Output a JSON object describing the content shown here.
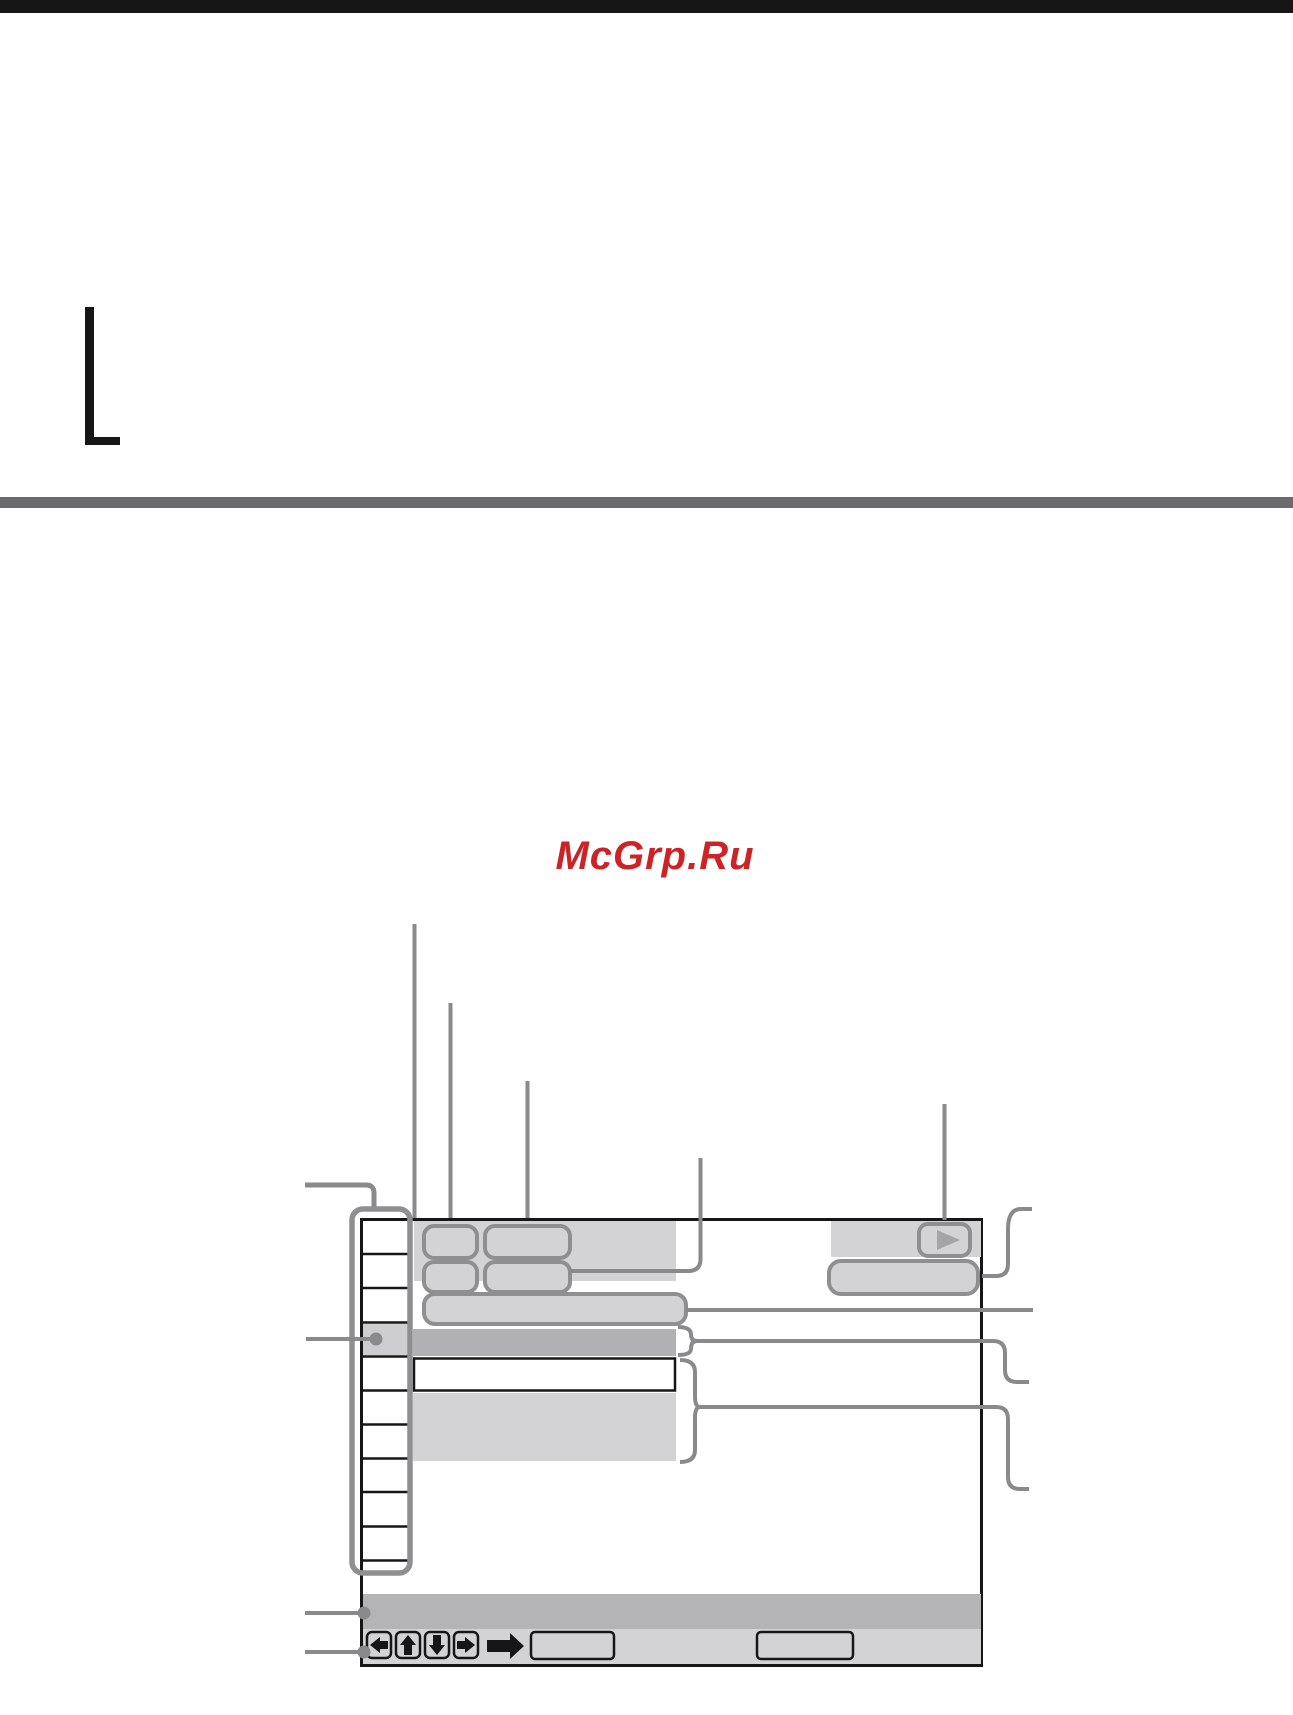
{
  "watermark": {
    "text": "McGrp.Ru"
  },
  "colors": {
    "paper": "#ffffff",
    "ink": "#161616",
    "rule": "#6b6b6d",
    "brand": "#cd2327",
    "line": "#8a8a8c",
    "outline": "#8f8f91",
    "light": "#d3d3d5",
    "mid": "#b4b4b6",
    "row_highlight": "#b1b1b3",
    "cell_selected": "#cecdd0",
    "triangle": "#a5a5a7"
  },
  "figure": {
    "description": "On-screen display (title list) layout diagram with blank callout leader lines",
    "thumbnail_rows": 10,
    "icons": [
      "play-icon",
      "left-arrow-icon",
      "up-arrow-icon",
      "down-arrow-icon",
      "right-arrow-icon",
      "big-right-arrow-icon",
      "bullet-dot-icon"
    ]
  }
}
